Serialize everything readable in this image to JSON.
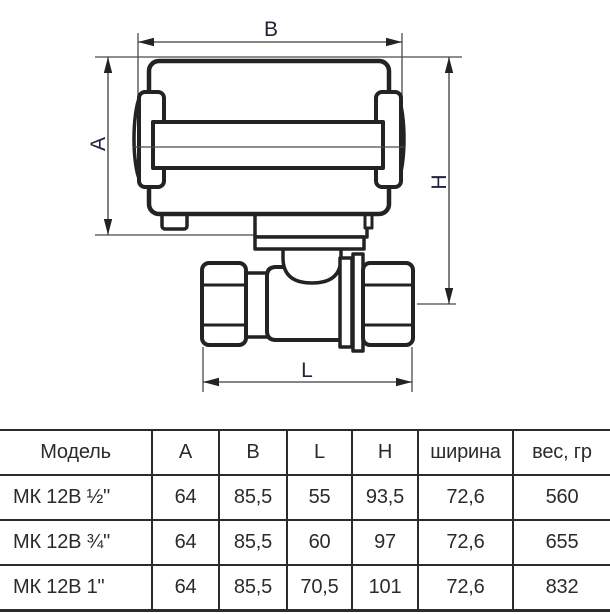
{
  "diagram": {
    "labels": {
      "width_b": "B",
      "height_a": "A",
      "height_h": "H",
      "length_l": "L"
    }
  },
  "table": {
    "headers": [
      "Модель",
      "A",
      "B",
      "L",
      "H",
      "ширина",
      "вес, гр"
    ],
    "rows": [
      [
        "МК 12В ½\"",
        "64",
        "85,5",
        "55",
        "93,5",
        "72,6",
        "560"
      ],
      [
        "МК 12В ¾\"",
        "64",
        "85,5",
        "60",
        "97",
        "72,6",
        "655"
      ],
      [
        "МК 12В 1\"",
        "64",
        "85,5",
        "70,5",
        "101",
        "72,6",
        "832"
      ]
    ]
  },
  "colors": {
    "drawing_line": "#232323",
    "dimension_line": "#3c3c3c",
    "label_text": "#20243a",
    "table_line": "#2b2b2b",
    "table_text": "#2b2b2b"
  }
}
